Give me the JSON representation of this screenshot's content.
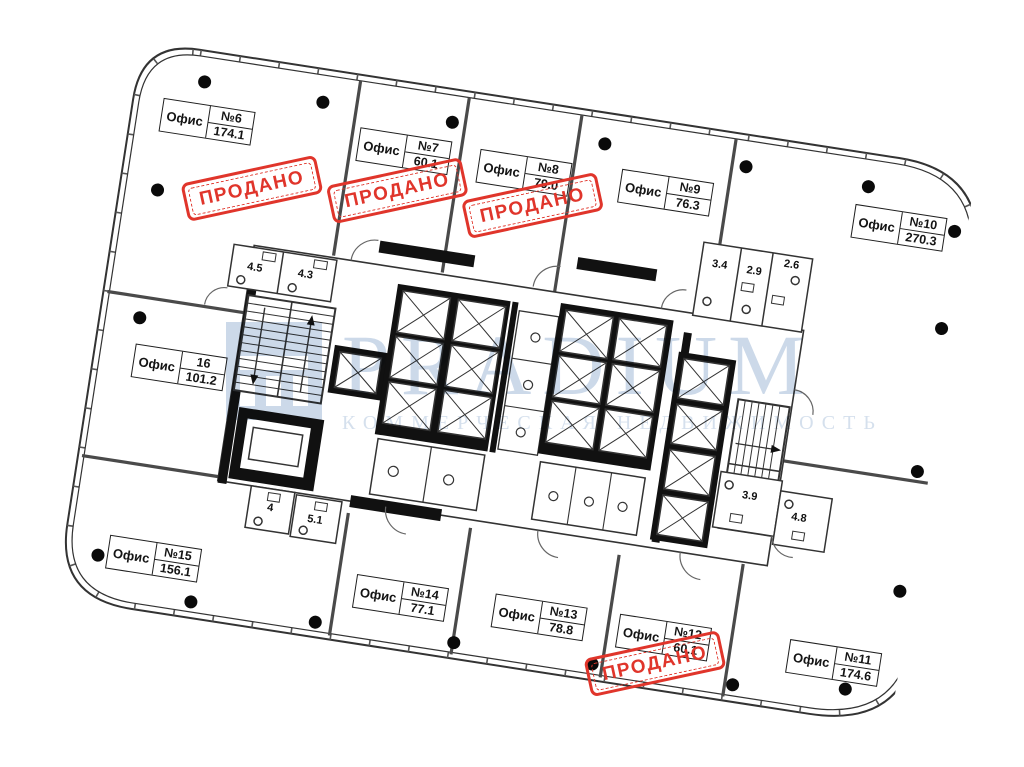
{
  "labels": {
    "office_word": "Офис",
    "sold_stamp": "ПРОДАНО"
  },
  "offices": [
    {
      "number": "№6",
      "area": "174.1",
      "sold": true
    },
    {
      "number": "№7",
      "area": "60.1",
      "sold": true
    },
    {
      "number": "№8",
      "area": "79.0",
      "sold": true
    },
    {
      "number": "№9",
      "area": "76.3",
      "sold": false
    },
    {
      "number": "№10",
      "area": "270.3",
      "sold": false
    },
    {
      "number": "16",
      "area": "101.2",
      "sold": false
    },
    {
      "number": "№15",
      "area": "156.1",
      "sold": false
    },
    {
      "number": "№14",
      "area": "77.1",
      "sold": false
    },
    {
      "number": "№13",
      "area": "78.8",
      "sold": false
    },
    {
      "number": "№12",
      "area": "60.1",
      "sold": true
    },
    {
      "number": "№11",
      "area": "174.6",
      "sold": false
    }
  ],
  "wet_rooms": [
    "4.5",
    "4.3",
    "3.4",
    "2.9",
    "2.6",
    "4",
    "5.1",
    "3.9",
    "4.8"
  ],
  "watermark": {
    "brand": "PRADIUM",
    "tagline": "КОММЕРЧЕСКАЯ НЕДВИЖИМОСТЬ"
  },
  "colors": {
    "stamp_red": "#e0352b",
    "watermark_blue": "#ccd9e9",
    "wall_dark": "#333333"
  }
}
